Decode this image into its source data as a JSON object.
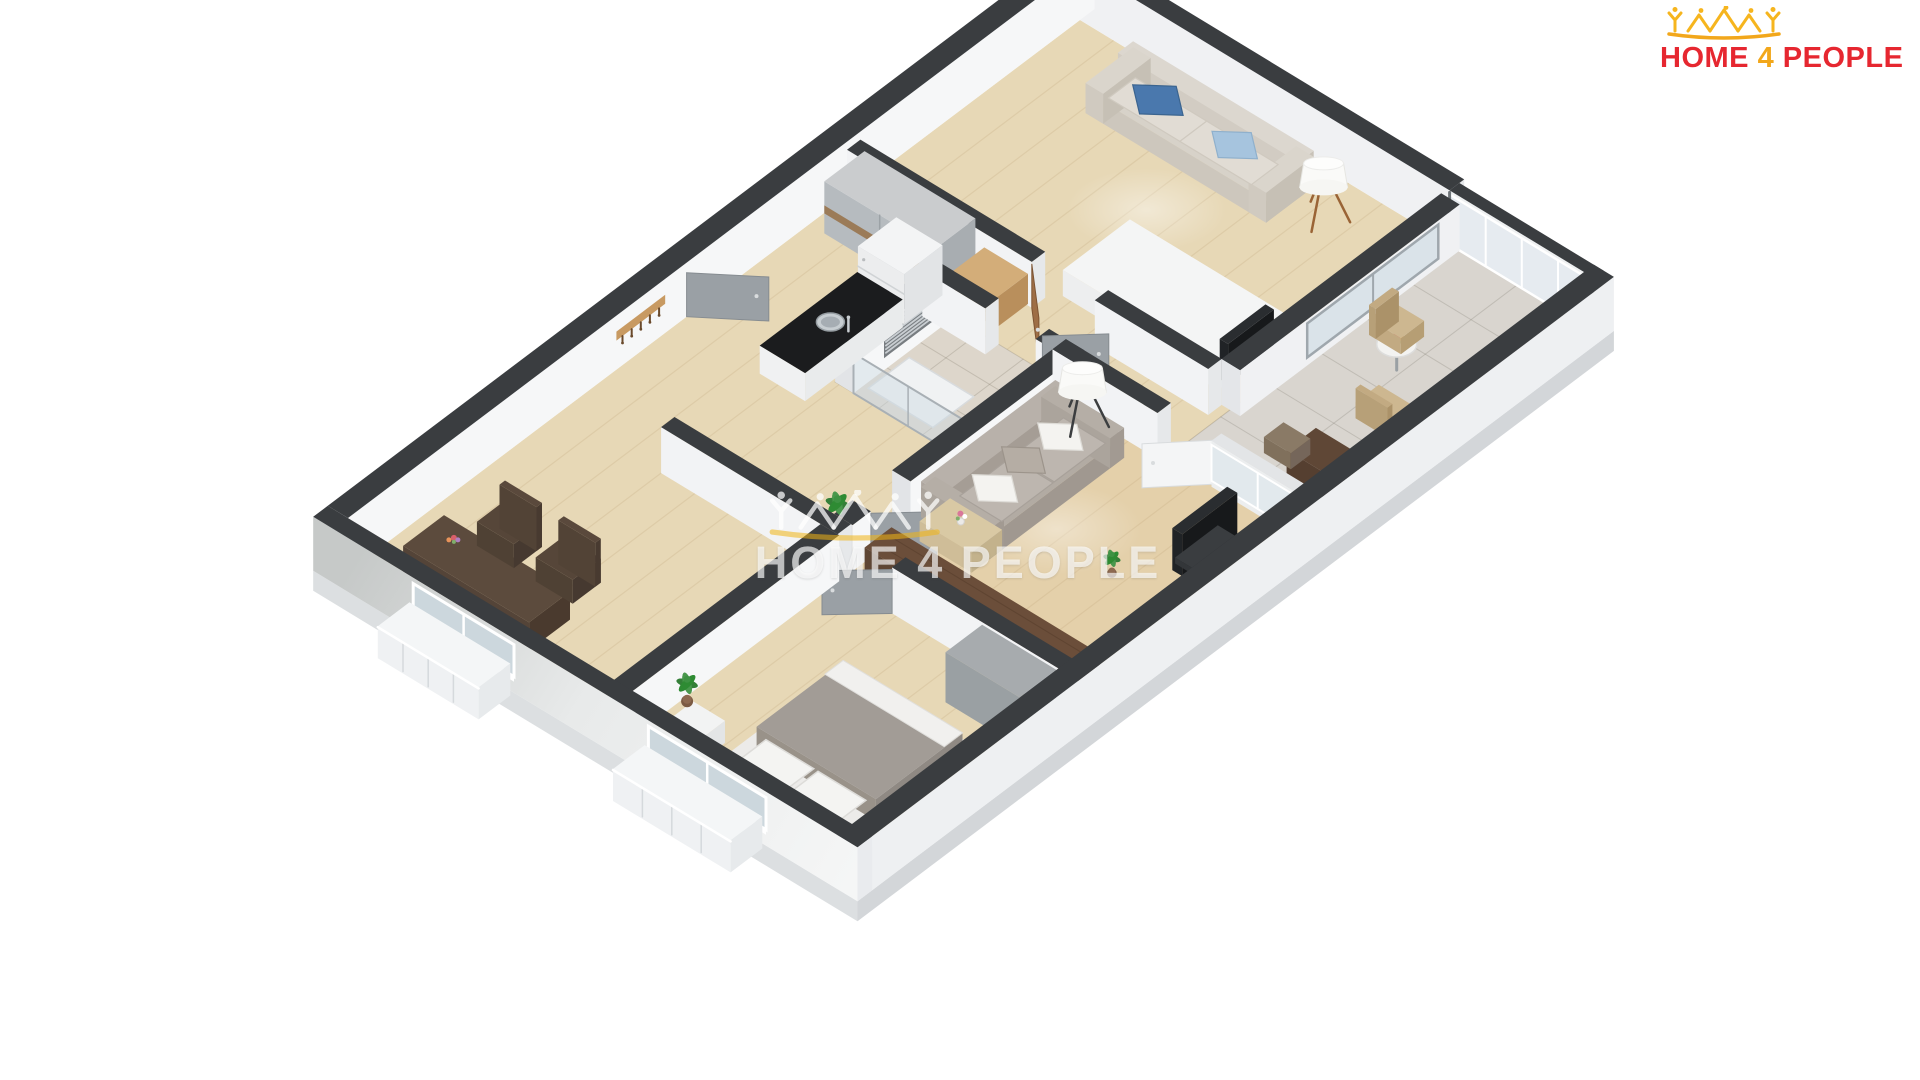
{
  "image": {
    "type": "3d-floor-plan-render",
    "description": "Isometric 3D dollhouse floor plan of a two-bedroom apartment with glazed loggia"
  },
  "branding": {
    "logo": {
      "text_home": "HOME",
      "text_four": "4",
      "text_people": "PEOPLE",
      "red": "#E62730",
      "yellow": "#F2A71B",
      "icon_yellow": "#F6B51E",
      "icon": "home4people-houses-icon"
    }
  },
  "watermark": {
    "text": "HOME 4 PEOPLE",
    "icon": "home4people-houses-icon",
    "color": "rgba(255,255,255,0.66)"
  },
  "scene": {
    "rooms": [
      {
        "name": "bedroom-living-top",
        "floor": "light-oak"
      },
      {
        "name": "glazed-loggia",
        "floor": "beige-tile"
      },
      {
        "name": "living-room",
        "floor": "light-oak"
      },
      {
        "name": "kitchen",
        "floor": "light-oak"
      },
      {
        "name": "bathroom",
        "floor": "beige-tile"
      },
      {
        "name": "hallway",
        "floor": "light-oak"
      },
      {
        "name": "dining-area",
        "floor": "light-oak"
      },
      {
        "name": "bedroom-bottom",
        "floor": "light-oak"
      }
    ],
    "furniture": [
      "beige-sofa-with-blue-pillows",
      "wood-tripod-floor-lamp",
      "white-table",
      "tv",
      "sliding-wardrobe-wood-band",
      "pine-chest-of-drawers",
      "coat-rack-5-hooks",
      "towel-radiator",
      "shower-glass",
      "fridge",
      "kitchen-counter-black-top",
      "steel-sink",
      "gray-sofa-with-pillows",
      "black-tripod-floor-lamp",
      "walnut-sideboard",
      "coffee-table-vase",
      "balcony-table-flowers",
      "wicker-chairs",
      "balcony-desk",
      "dark-dining-table",
      "two-slat-back-chairs",
      "double-bed-gray-duvet",
      "nightstand",
      "gray-wardrobe",
      "potted-plants",
      "french-balconies"
    ],
    "palette": {
      "wall_cap": "#3A3D40",
      "wall_face_light": "#F4F5F7",
      "wall_face_shade": "#E6E8EA",
      "exterior_face": "#EEF0F2",
      "floor_wood": "#E7D8B6",
      "floor_tile_bath": "#DDD6CB",
      "floor_tile_balcony": "#D9D5CF",
      "sofa_beige": "#D7D2C9",
      "sofa_gray": "#B2ABA3",
      "pillow_blue": "#4A78AD",
      "pillow_light_blue": "#A6C4DE",
      "walnut": "#6B4E3A",
      "bed_duvet": "#A29C96",
      "door_gray": "#9AA0A5",
      "door_white": "#F4F5F6",
      "door_wood_brown": "#9E6E46",
      "plant_green": "#3E8E41",
      "counter_black": "#1B1C1E",
      "glass": "#D6E0E6",
      "chrome": "#C9CED2"
    }
  }
}
